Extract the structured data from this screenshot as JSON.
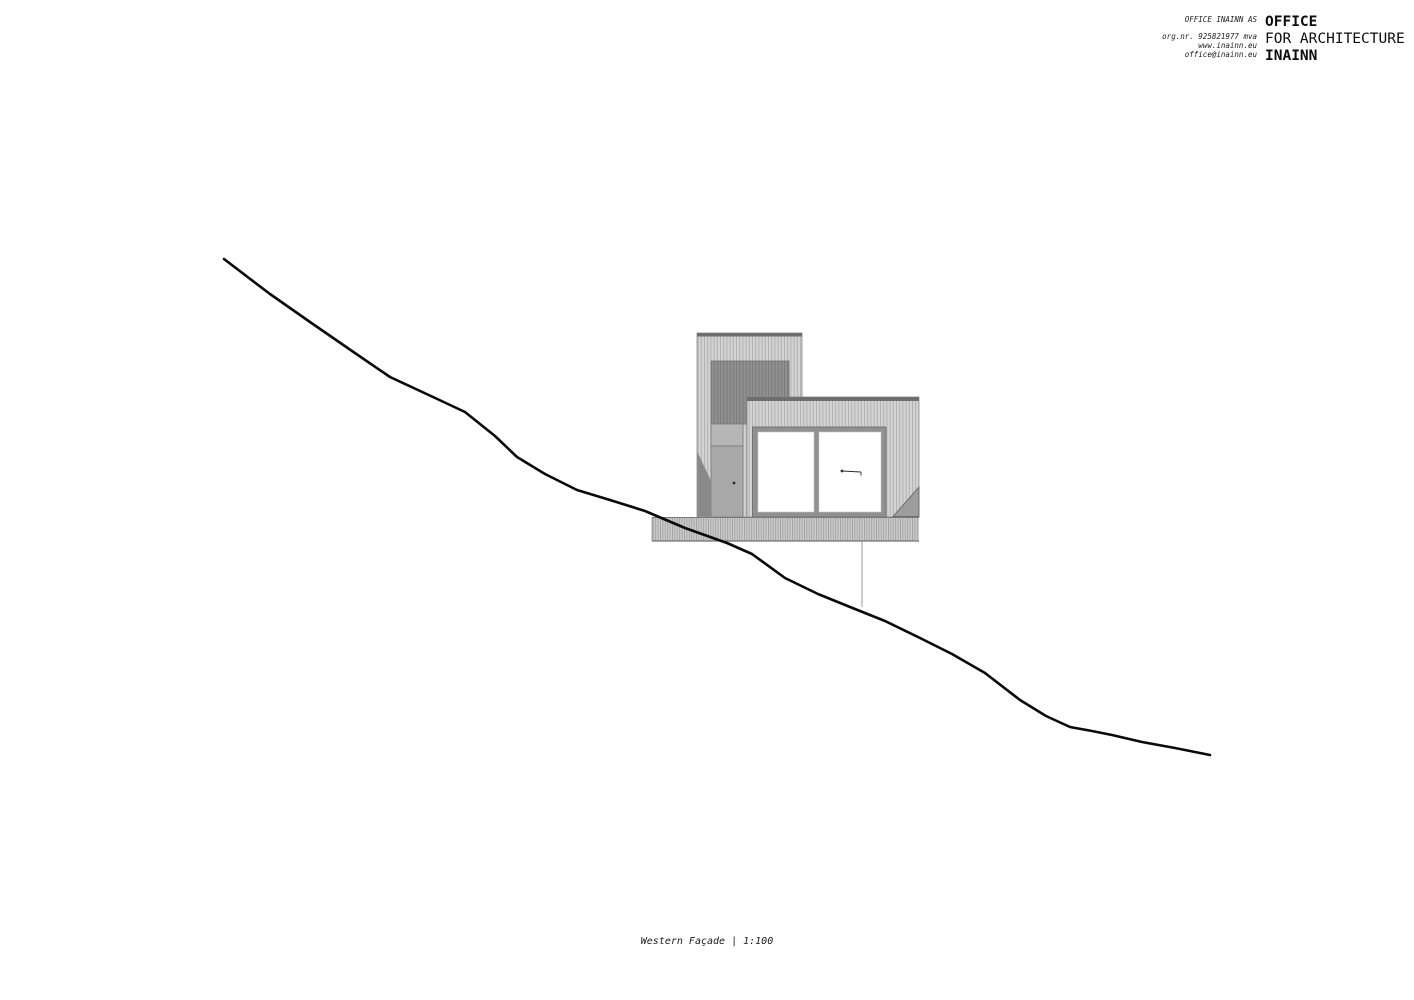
{
  "header": {
    "info": {
      "company": "OFFICE INAINN AS",
      "org_nr": "org.nr. 925821977 mva",
      "website": "www.inainn.eu",
      "email": "office@inainn.eu"
    },
    "wordmark": {
      "line1": "OFFICE",
      "line2": "FOR ARCHITECTURE",
      "line3": "INAINN"
    }
  },
  "drawing": {
    "view_name": "Western Façade",
    "scale": "1:100",
    "caption": "Western Façade | 1:100",
    "colors": {
      "terrain_line": "#0a0a0a",
      "siding_light": "#d3d3d3",
      "siding_stripe": "#b2b2b2",
      "panel_dark": "#8f8f8f",
      "roof_cap": "#6e6e6e",
      "door": "#a8a8a8",
      "background": "#ffffff"
    }
  }
}
